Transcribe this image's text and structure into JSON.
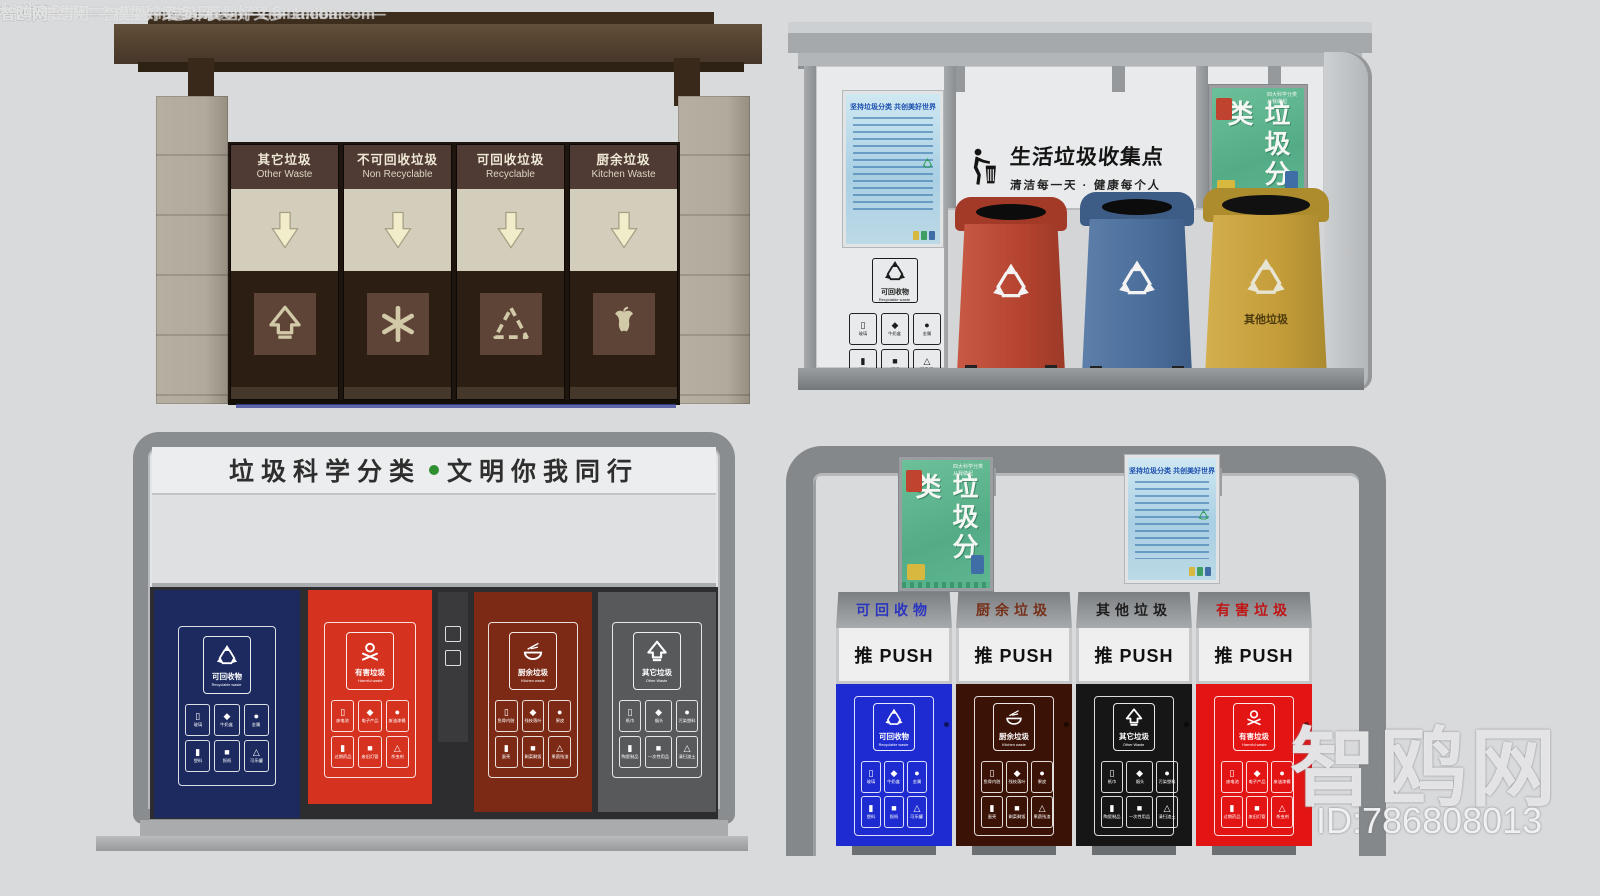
{
  "watermarks": {
    "brand": "智鸥网",
    "site": "1miba.com",
    "slogan": "模型好又多",
    "model_id": "ID:786808013",
    "rows": [
      {
        "text": "—— 智鸥网 ——————— 模型好又多 ——————"
      },
      {
        "text": "— — — — — 智鸥网 — ——————— 1miba.com"
      },
      {
        "text": "智鸥网 — —"
      },
      {
        "text": "智鸥网"
      },
      {
        "text": "1miba.com— — — — 智鸥网 — — 1miba.com"
      },
      {
        "text": "智鸥网 — — — — 1miba.com ·"
      },
      {
        "text": "— — 智鸥网"
      },
      {
        "text": "智鸥网 — · — — — — 1miba.com — —"
      },
      {
        "text": "1miba.com — — — — —"
      },
      {
        "text": "智鸥网 — — — 模型好又多 — — · — —"
      },
      {
        "text": "— — — —"
      }
    ]
  },
  "palette": {
    "background": "#d9dadb",
    "wood_roof": "#55432f",
    "stone_pillar": "#b2aa9d",
    "bin_red": "#bf4b38",
    "bin_blue": "#4d6f9d",
    "bin_yellow": "#c9a23e",
    "c_navy": "#1c2a5f",
    "c_red": "#d63220",
    "c_brick": "#7c2a15",
    "c_gray": "#57595b",
    "d_blue": "#1d2bd0",
    "d_brown": "#3a1206",
    "d_black": "#161616",
    "d_red": "#e31414",
    "header_dot_green": "#2f8f2f"
  },
  "waste_items": {
    "recyclable": [
      "玻璃",
      "牛奶盒",
      "金属",
      "塑料",
      "报纸",
      "可乐罐"
    ],
    "harmful": [
      "废电池",
      "电子产品",
      "废油漆桶",
      "过期药品",
      "废旧灯管",
      "杀虫剂"
    ],
    "kitchen": [
      "鱼骨内脏",
      "残枝落叶",
      "果皮",
      "蛋壳",
      "剩菜剩饭",
      "果蔬残渣"
    ],
    "other": [
      "纸巾",
      "烟头",
      "污染塑料",
      "陶瓷制品",
      "一次性用品",
      "清扫渣土"
    ]
  },
  "stationA": {
    "compartments": [
      {
        "cn": "其它垃圾",
        "en": "Other Waste"
      },
      {
        "cn": "不可回收垃圾",
        "en": "Non Recyclable"
      },
      {
        "cn": "可回收垃圾",
        "en": "Recyclable"
      },
      {
        "cn": "厨余垃圾",
        "en": "Kitchen Waste"
      }
    ]
  },
  "stationB": {
    "title": "生活垃圾收集点",
    "subtitle": "清洁每一天 · 健康每个人",
    "placard": {
      "cn": "可回收物",
      "en": "Recyclable waste"
    },
    "bins": [
      {
        "name": "red-wheeled-bin",
        "label": ""
      },
      {
        "name": "blue-wheeled-bin",
        "label": ""
      },
      {
        "name": "yellow-wheeled-bin",
        "label": "其他垃圾"
      }
    ]
  },
  "posters": {
    "blue_title": "坚持垃圾分类 共创美好世界",
    "green_title": "垃圾分类",
    "green_note": "四大科学分类 从我做起"
  },
  "stationC": {
    "header_left": "垃圾科学分类",
    "header_right": "文明你我同行",
    "bins": [
      {
        "cn": "可回收物",
        "en": "Recyclable waste"
      },
      {
        "cn": "有害垃圾",
        "en": "Harmful waste"
      },
      {
        "cn": "厨余垃圾",
        "en": "Kitchen waste"
      },
      {
        "cn": "其它垃圾",
        "en": "Other Waste"
      }
    ]
  },
  "stationD": {
    "push": "推 PUSH",
    "units": [
      {
        "label": "可回收物",
        "sticker_cn": "可回收物",
        "sticker_en": "Recyclable waste"
      },
      {
        "label": "厨余垃圾",
        "sticker_cn": "厨余垃圾",
        "sticker_en": "Kitchen waste"
      },
      {
        "label": "其他垃圾",
        "sticker_cn": "其它垃圾",
        "sticker_en": "Other Waste"
      },
      {
        "label": "有害垃圾",
        "sticker_cn": "有害垃圾",
        "sticker_en": "Harmful waste"
      }
    ]
  }
}
